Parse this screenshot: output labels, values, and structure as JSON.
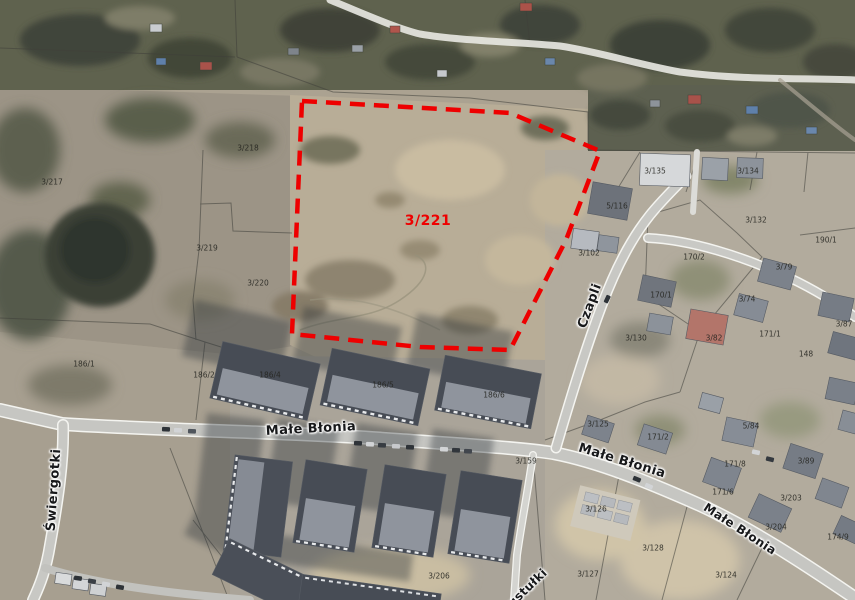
{
  "map": {
    "type": "aerial-cadastral-view",
    "street_labels": [
      {
        "text": "Małe Błonia",
        "x": 311,
        "y": 429,
        "rot": -3,
        "size": 13
      },
      {
        "text": "Małe Błonia",
        "x": 622,
        "y": 461,
        "rot": 17,
        "size": 13
      },
      {
        "text": "Małe Błonia",
        "x": 740,
        "y": 529,
        "rot": 33,
        "size": 12
      },
      {
        "text": "Czapli",
        "x": 590,
        "y": 306,
        "rot": -70,
        "size": 13
      },
      {
        "text": "Świergotki",
        "x": 54,
        "y": 490,
        "rot": -86,
        "size": 13
      },
      {
        "text": "Pustułki",
        "x": 524,
        "y": 591,
        "rot": -44,
        "size": 12
      }
    ],
    "parcel_labels": [
      {
        "text": "3/217",
        "x": 52,
        "y": 182
      },
      {
        "text": "3/218",
        "x": 248,
        "y": 148
      },
      {
        "text": "3/219",
        "x": 207,
        "y": 248
      },
      {
        "text": "3/220",
        "x": 258,
        "y": 283
      },
      {
        "text": "186/1",
        "x": 84,
        "y": 364
      },
      {
        "text": "186/2",
        "x": 204,
        "y": 375
      },
      {
        "text": "186/4",
        "x": 270,
        "y": 375
      },
      {
        "text": "186/5",
        "x": 383,
        "y": 385
      },
      {
        "text": "186/6",
        "x": 494,
        "y": 395
      },
      {
        "text": "3/135",
        "x": 655,
        "y": 171
      },
      {
        "text": "3/134",
        "x": 748,
        "y": 171
      },
      {
        "text": "5/116",
        "x": 617,
        "y": 206
      },
      {
        "text": "3/132",
        "x": 756,
        "y": 220
      },
      {
        "text": "190/1",
        "x": 826,
        "y": 240
      },
      {
        "text": "170/2",
        "x": 694,
        "y": 257
      },
      {
        "text": "3/102",
        "x": 589,
        "y": 253
      },
      {
        "text": "3/79",
        "x": 784,
        "y": 267
      },
      {
        "text": "170/1",
        "x": 661,
        "y": 295
      },
      {
        "text": "3/74",
        "x": 747,
        "y": 299
      },
      {
        "text": "3/130",
        "x": 636,
        "y": 338
      },
      {
        "text": "3/82",
        "x": 714,
        "y": 338
      },
      {
        "text": "171/1",
        "x": 770,
        "y": 334
      },
      {
        "text": "148",
        "x": 806,
        "y": 354
      },
      {
        "text": "3/87",
        "x": 844,
        "y": 324
      },
      {
        "text": "3/125",
        "x": 598,
        "y": 424
      },
      {
        "text": "171/2",
        "x": 658,
        "y": 437
      },
      {
        "text": "5/84",
        "x": 751,
        "y": 426
      },
      {
        "text": "171/8",
        "x": 735,
        "y": 464
      },
      {
        "text": "3/89",
        "x": 806,
        "y": 461
      },
      {
        "text": "171/6",
        "x": 723,
        "y": 492
      },
      {
        "text": "3/203",
        "x": 791,
        "y": 498
      },
      {
        "text": "3/204",
        "x": 776,
        "y": 527
      },
      {
        "text": "174/9",
        "x": 838,
        "y": 537
      },
      {
        "text": "3/126",
        "x": 596,
        "y": 509
      },
      {
        "text": "3/128",
        "x": 653,
        "y": 548
      },
      {
        "text": "3/127",
        "x": 588,
        "y": 574
      },
      {
        "text": "3/124",
        "x": 726,
        "y": 575
      },
      {
        "text": "3/159",
        "x": 526,
        "y": 461
      },
      {
        "text": "3/206",
        "x": 439,
        "y": 576
      }
    ],
    "highlight": {
      "label": "3/221",
      "label_x": 428,
      "label_y": 221,
      "color": "#ee0000",
      "vertices": "302,101 510,113 600,151 566,240 510,350 420,347 292,334"
    }
  }
}
